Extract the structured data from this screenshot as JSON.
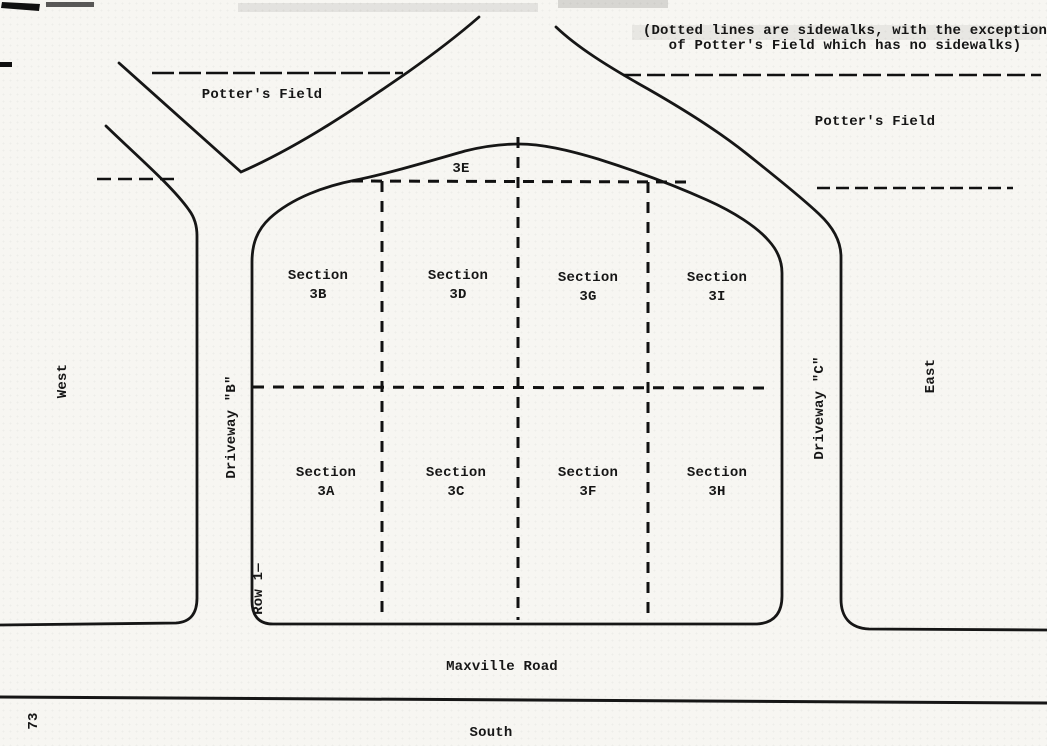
{
  "note": {
    "line1": "(Dotted lines are sidewalks, with the exception",
    "line2": "of Potter's Field which has no sidewalks)"
  },
  "labels": {
    "potters_field_left": "Potter's Field",
    "potters_field_right": "Potter's Field",
    "west": "West",
    "east": "East",
    "south": "South",
    "maxville_road": "Maxville Road",
    "driveway_b": "Driveway \"B\"",
    "driveway_c": "Driveway \"C\"",
    "row_1": "Row 1—",
    "area_3e": "3E",
    "page_number": "73"
  },
  "sections": {
    "3A": {
      "label": "Section",
      "code": "3A"
    },
    "3B": {
      "label": "Section",
      "code": "3B"
    },
    "3C": {
      "label": "Section",
      "code": "3C"
    },
    "3D": {
      "label": "Section",
      "code": "3D"
    },
    "3F": {
      "label": "Section",
      "code": "3F"
    },
    "3G": {
      "label": "Section",
      "code": "3G"
    },
    "3H": {
      "label": "Section",
      "code": "3H"
    },
    "3I": {
      "label": "Section",
      "code": "3I"
    }
  },
  "legend_meaning": {
    "dotted_lines": "sidewalks"
  },
  "colors": {
    "ink": "#161616",
    "paper": "#f7f6f2"
  }
}
